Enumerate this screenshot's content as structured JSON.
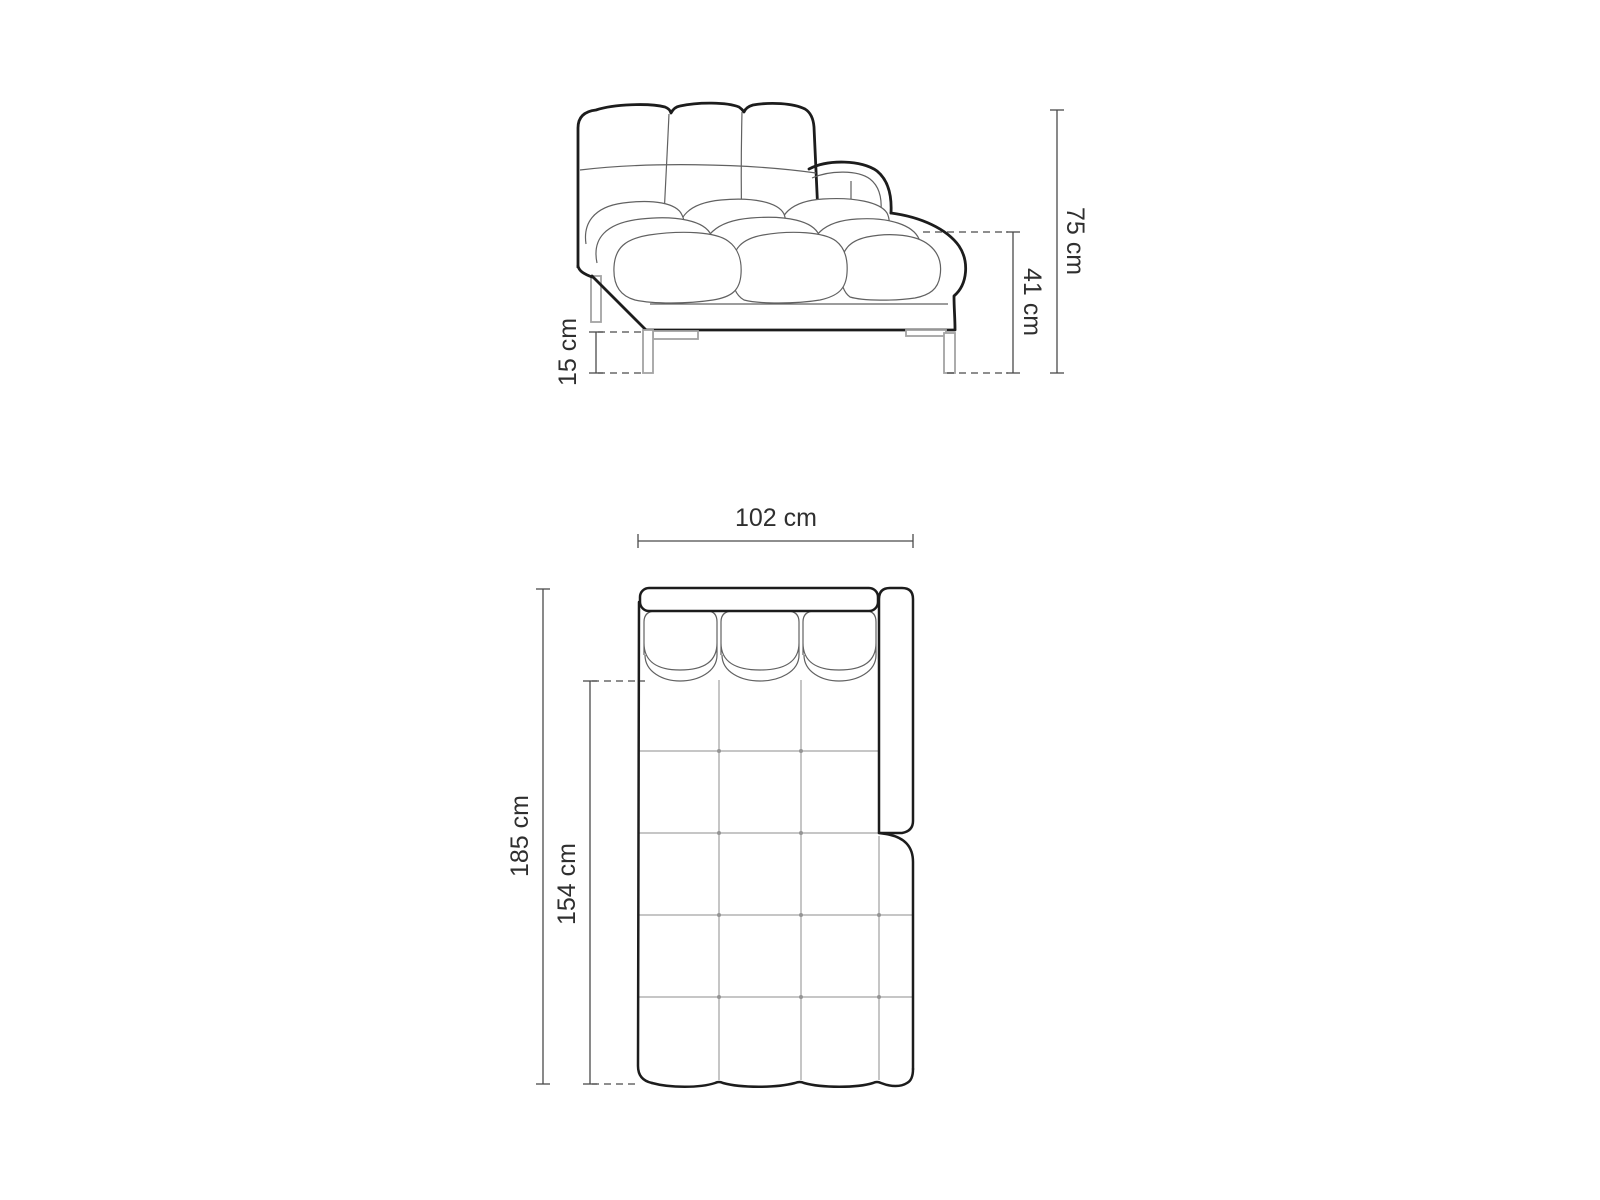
{
  "diagram": {
    "type": "furniture-dimension-drawing",
    "subject": "tufted chaise lounge sofa, side elevation (top) and top plan view (bottom)",
    "colors": {
      "background": "#ffffff",
      "outline": "#1c1c1c",
      "detail_line": "#616161",
      "quilting_grid": "#8d8d8d",
      "leg_line": "#a3a3a3",
      "dimension_line": "#4a4a4a",
      "label_text": "#2f2f2f"
    },
    "side_view": {
      "dimensions": {
        "total_height": "75 cm",
        "seat_height": "41 cm",
        "leg_height": "15 cm"
      }
    },
    "plan_view": {
      "dimensions": {
        "width": "102 cm",
        "total_length": "185 cm",
        "chaise_length": "154 cm"
      }
    }
  }
}
